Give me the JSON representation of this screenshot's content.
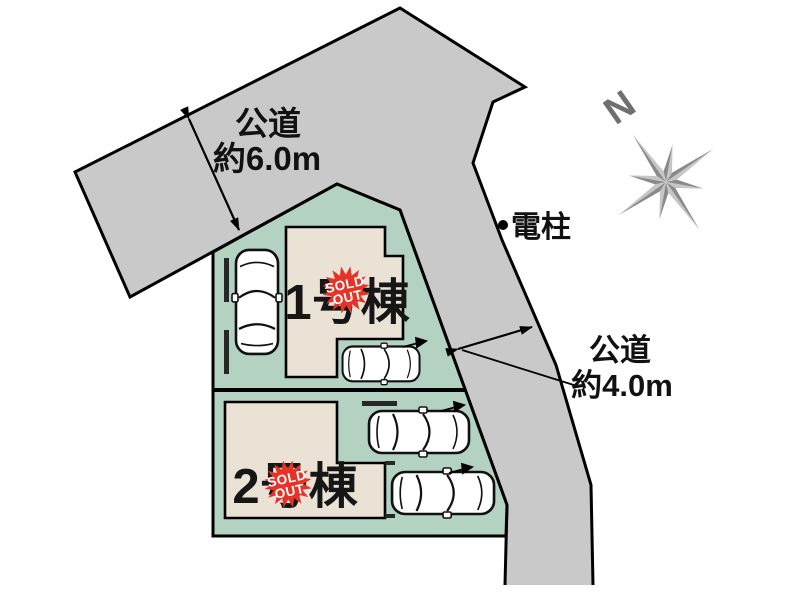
{
  "plan": {
    "road_top": {
      "name_label": "公道",
      "width_label": "約6.0m"
    },
    "road_right": {
      "name_label": "公道",
      "width_label": "約4.0m"
    },
    "utility_pole_label": "電柱",
    "compass_label": "N",
    "lots": [
      {
        "building_label": "1号棟",
        "badge_line1": "SOLD",
        "badge_line2": "OUT"
      },
      {
        "building_label": "2号棟",
        "badge_line1": "SOLD",
        "badge_line2": "OUT"
      }
    ],
    "colors": {
      "road": "#c9c9c9",
      "outline": "#000000",
      "lot": "#b4d2c2",
      "building": "#eae2d4",
      "badge": "#e53427",
      "compass_dark": "#8a8a8a",
      "compass_light": "#c6c6c6",
      "compass_letter": "#6f6f6f"
    }
  }
}
